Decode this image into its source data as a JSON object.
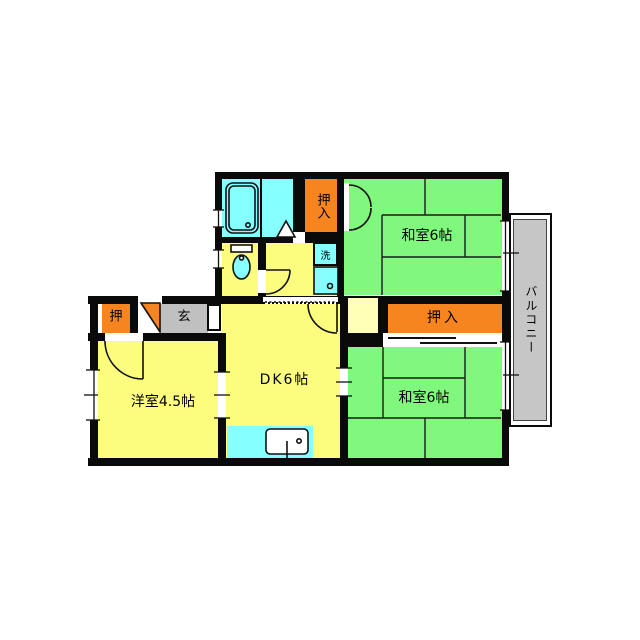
{
  "floorplan": {
    "labels": {
      "washitsu_top": "和室6帖",
      "washitsu_bottom": "和室6帖",
      "dk": "DK6帖",
      "youshitsu": "洋室4.5帖",
      "oshiire_top": "押入",
      "oshiire_bottom": "押入",
      "oshi": "押",
      "genkan": "玄",
      "laundry": "洗",
      "balcony": "バルコニー"
    },
    "colors": {
      "tatami_green": "#80F87D",
      "floor_yellow": "#FCFC7E",
      "closet_orange": "#F6841F",
      "water_cyan": "#85FFFF",
      "genkan_gray": "#C0C0C0",
      "balcony_gray": "#C6C6C6",
      "alcove_pale": "#FFFFB8",
      "wall_black": "#0A0A0A"
    }
  }
}
